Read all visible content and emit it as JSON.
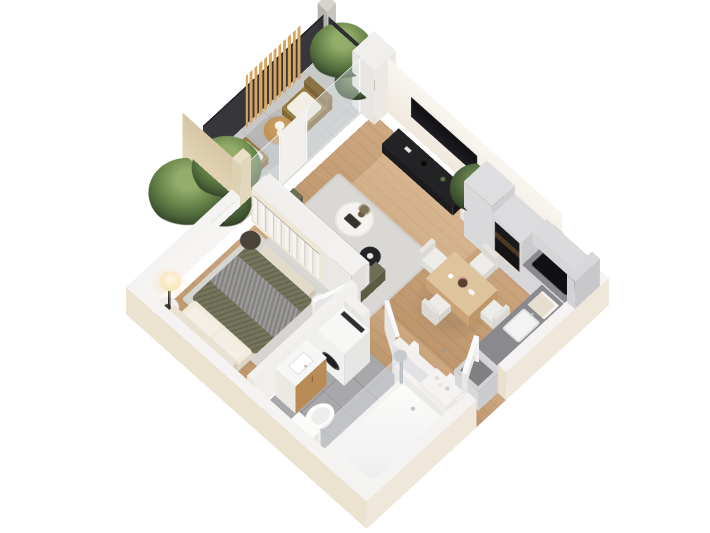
{
  "scene": {
    "title": "3D isometric floor plan render of a one-bedroom apartment",
    "view": "isometric dollhouse cutaway seen from above",
    "background": "#ffffff"
  },
  "palette": {
    "background": "#ffffff",
    "wood_floor": "#c79e72",
    "wall_white": "#f4f3f1",
    "wall_interior_warm": "#f6f1e9",
    "exterior_cream": "#ebe2cf",
    "bathroom_tile": "#a8a8ab",
    "balcony_tile": "#c8c8c6",
    "sofa_olive": "#7a795f",
    "duvet_olive": "#6d6e53",
    "rug_gray": "#d8d7d3",
    "cabinet_gray": "#d7d6d8",
    "countertop_gray": "#8a8a8e",
    "appliance_black": "#141416",
    "slat_wood": "#d8a55f",
    "rattan": "#93793f",
    "beige_wall": "#e0d2b3",
    "plant_green": "#5d7a44",
    "warm_light": "#ffd9a2"
  },
  "rooms": {
    "living_room": {
      "name": "Living room",
      "floor": "light oak wood",
      "furniture": [
        "wall-mounted flat TV",
        "black media console with decor",
        "olive green tufted sofa with pillows",
        "round white coffee table with books and branch vase",
        "black round side table",
        "light gray area rug",
        "potted fiddle-leaf fig in white pot",
        "sliding glass door to balcony"
      ]
    },
    "dining_area": {
      "name": "Dining area",
      "furniture": [
        "square light wood dining table",
        "four white chairs",
        "flowers, cups and plate on table"
      ]
    },
    "kitchen": {
      "name": "Kitchen",
      "furniture": [
        "light gray L-shaped cabinets",
        "dark gray countertop",
        "built-in black oven and microwave tower with warm light",
        "black cooktop",
        "white sink with faucet",
        "upper wall cabinets",
        "tall cabinet"
      ]
    },
    "bedroom": {
      "name": "Bedroom",
      "furniture": [
        "double bed with olive green duvet and gray knit throw",
        "cream upholstered headboard with pillows",
        "round white nightstand",
        "black floor lamp with glowing shade",
        "open wardrobe with hanging clothes",
        "white dresser",
        "bench at foot of bed",
        "dark round pouf",
        "gray area rug",
        "glass door to balcony"
      ]
    },
    "bathroom": {
      "name": "Bathroom",
      "floor": "gray tile",
      "furniture": [
        "bathtub with chrome shower column",
        "glass shower partition",
        "white toilet",
        "wood vanity with white basin",
        "washing machine",
        "white interior door"
      ]
    },
    "hallway": {
      "name": "Entry hallway",
      "furniture": [
        "open white front door",
        "open shelf unit with accessories",
        "door frame posts"
      ]
    },
    "balcony": {
      "name": "Balcony",
      "floor": "gray tile",
      "furniture": [
        "two rattan lounge chairs with white cushions",
        "round wooden coffee table with white flowers",
        "vertical wood slat privacy screen",
        "dark metal railing",
        "tall beige privacy wall",
        "concrete pillar",
        "potted palms and ferns"
      ]
    }
  }
}
